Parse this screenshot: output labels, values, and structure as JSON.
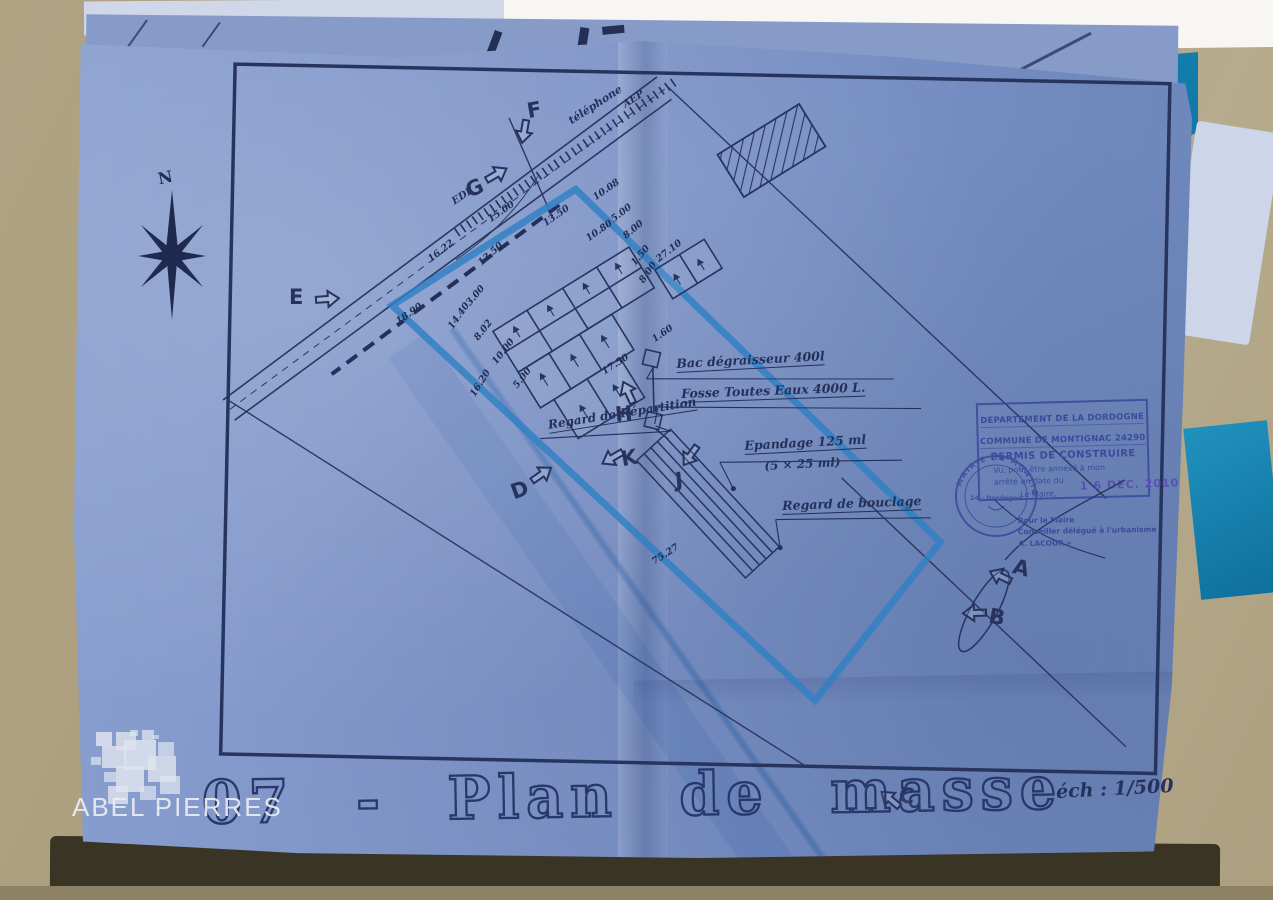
{
  "photo": {
    "watermark_text": "ABEL PIERRES"
  },
  "colors": {
    "paper_blue": "#7e95c8",
    "ink_navy": "#232f56",
    "boundary_marker_blue": "#2f80c4",
    "folder_teal": "#1b86b4",
    "stamp_blue": "#3c4a9c",
    "date_stamp_purple": "#5a50b0"
  },
  "plan": {
    "title": "07 - Plan de masse",
    "scale": "éch : 1/500",
    "north_label": "N",
    "annotations": [
      {
        "t": "téléphone",
        "x": 566,
        "y": 116,
        "r": -33,
        "u": false,
        "fs": 11
      },
      {
        "t": "AEP",
        "x": 621,
        "y": 101,
        "r": -33,
        "u": false,
        "fs": 10
      },
      {
        "t": "EDF",
        "x": 450,
        "y": 198,
        "r": -33,
        "u": false,
        "fs": 10
      },
      {
        "t": "Bac dégraisseur 400l",
        "x": 676,
        "y": 356,
        "r": -3,
        "u": true,
        "fs": 12.5
      },
      {
        "t": "Fosse Toutes Eaux  4000 L.",
        "x": 681,
        "y": 386,
        "r": -2,
        "u": true,
        "fs": 12.5
      },
      {
        "t": "Epandage  125 ml",
        "x": 744,
        "y": 438,
        "r": -3,
        "u": true,
        "fs": 12.5
      },
      {
        "t": "(5 × 25 ml)",
        "x": 764,
        "y": 459,
        "r": -3,
        "u": false,
        "fs": 12
      },
      {
        "t": "Regard de Répartition",
        "x": 547,
        "y": 418,
        "r": -9,
        "u": true,
        "fs": 12
      },
      {
        "t": "Regard de bouclage",
        "x": 782,
        "y": 498,
        "r": -2,
        "u": true,
        "fs": 12.5
      }
    ],
    "dimensions": [
      {
        "t": "16.22",
        "x": 426,
        "y": 256,
        "r": -38
      },
      {
        "t": "15.00",
        "x": 486,
        "y": 216,
        "r": -35
      },
      {
        "t": "13.50",
        "x": 541,
        "y": 220,
        "r": -35
      },
      {
        "t": "13.50",
        "x": 476,
        "y": 260,
        "r": -42
      },
      {
        "t": "10.80",
        "x": 584,
        "y": 235,
        "r": -35
      },
      {
        "t": "10.08",
        "x": 591,
        "y": 194,
        "r": -35
      },
      {
        "t": "5.00",
        "x": 609,
        "y": 216,
        "r": -38
      },
      {
        "t": "8.00",
        "x": 621,
        "y": 233,
        "r": -40
      },
      {
        "t": "27.10",
        "x": 654,
        "y": 256,
        "r": -38
      },
      {
        "t": "1.50",
        "x": 629,
        "y": 261,
        "r": -50
      },
      {
        "t": "8.00",
        "x": 637,
        "y": 279,
        "r": -55
      },
      {
        "t": "3.00",
        "x": 464,
        "y": 301,
        "r": -50
      },
      {
        "t": "18.90",
        "x": 394,
        "y": 318,
        "r": -35
      },
      {
        "t": "14.40",
        "x": 446,
        "y": 325,
        "r": -55
      },
      {
        "t": "8.02",
        "x": 472,
        "y": 336,
        "r": -52
      },
      {
        "t": "10.00",
        "x": 490,
        "y": 360,
        "r": -52
      },
      {
        "t": "5.00",
        "x": 511,
        "y": 384,
        "r": -52
      },
      {
        "t": "16.20",
        "x": 468,
        "y": 393,
        "r": -58
      },
      {
        "t": "17.50",
        "x": 600,
        "y": 368,
        "r": -33
      },
      {
        "t": "1.60",
        "x": 650,
        "y": 336,
        "r": -35
      },
      {
        "t": "75.27",
        "x": 650,
        "y": 558,
        "r": -33
      }
    ],
    "view_markers": [
      {
        "letter": "F",
        "x": 527,
        "y": 98,
        "lr": -10,
        "ax": -16,
        "ay": 24,
        "ar": 100
      },
      {
        "letter": "G",
        "x": 466,
        "y": 176,
        "lr": -25,
        "ax": 18,
        "ay": -12,
        "ar": -30
      },
      {
        "letter": "E",
        "x": 289,
        "y": 285,
        "lr": 0,
        "ax": 26,
        "ay": 4,
        "ar": -4
      },
      {
        "letter": "D",
        "x": 511,
        "y": 478,
        "lr": -20,
        "ax": 18,
        "ay": -14,
        "ar": -35
      },
      {
        "letter": "H",
        "x": 615,
        "y": 402,
        "lr": -5,
        "ax": 0,
        "ay": -20,
        "ar": -115
      },
      {
        "letter": "K",
        "x": 621,
        "y": 446,
        "lr": -10,
        "ax": -22,
        "ay": 2,
        "ar": 150
      },
      {
        "letter": "J",
        "x": 675,
        "y": 468,
        "lr": -5,
        "ax": 2,
        "ay": -22,
        "ar": 125
      },
      {
        "letter": "A",
        "x": 1013,
        "y": 556,
        "lr": 15,
        "ax": -26,
        "ay": 10,
        "ar": -155
      },
      {
        "letter": "B",
        "x": 989,
        "y": 605,
        "lr": 10,
        "ax": -28,
        "ay": -2,
        "ar": 178
      },
      {
        "letter": "C",
        "x": 899,
        "y": 784,
        "lr": 5,
        "ax": -22,
        "ay": 5,
        "ar": -140
      }
    ]
  },
  "stamp": {
    "line1": "DEPARTEMENT DE LA DORDOGNE",
    "line2": "COMMUNE DE MONTIGNAC 24290",
    "line3": "PERMIS DE CONSTRUIRE",
    "line4": "Vu, pour être annexé à mon",
    "line5": "arrêté en date du",
    "line6": "Le Maire,",
    "date": "1 6 DEC. 2010",
    "seal_arc": "MAIRIE DE MONTIGNAC",
    "seal_center": "24 · Dordogne",
    "sig1": "Pour le Maire",
    "sig2": "Conseiller délégué à l'urbanisme",
    "sig3": "A. LACOUR »"
  }
}
